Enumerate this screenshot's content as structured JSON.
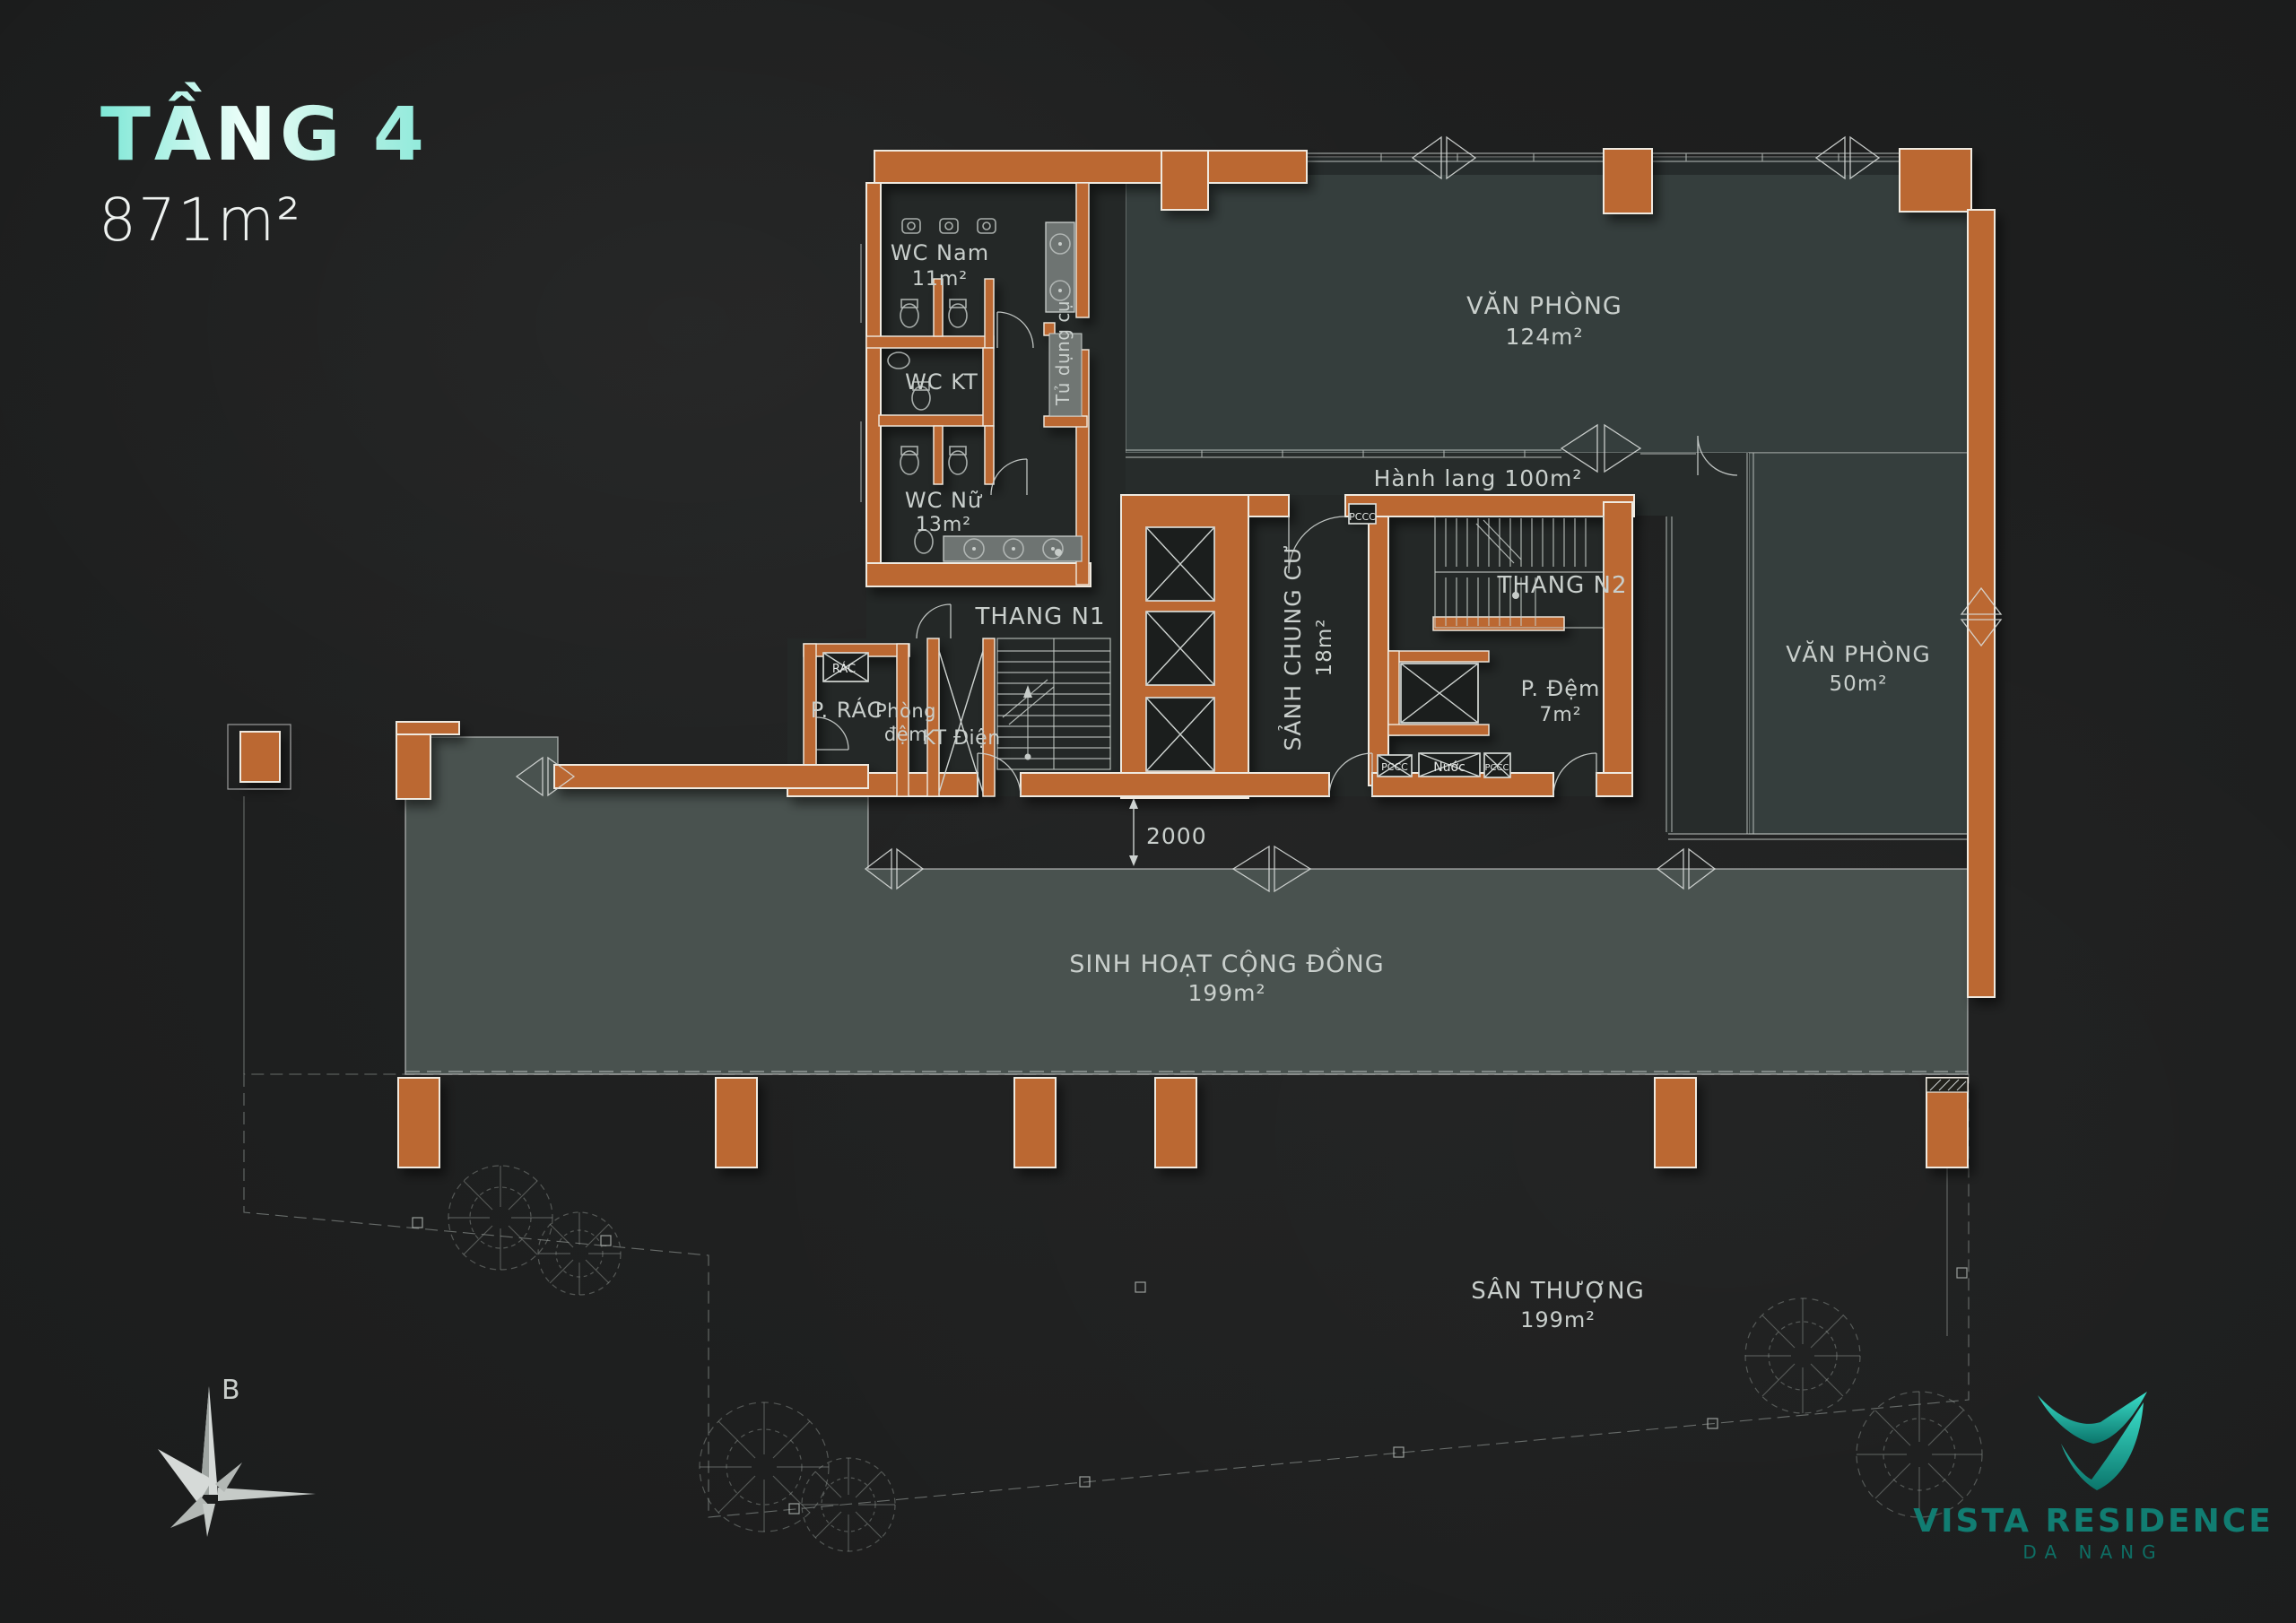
{
  "header": {
    "floor_title": "TẦNG 4",
    "floor_area": "871m²"
  },
  "colors": {
    "background": "#1b1c1c",
    "wall_orange": "#bb6830",
    "wall_outline": "#efe9df",
    "office_fill": "#353e3d",
    "community_fill": "#49524f",
    "core_fill": "#242827",
    "title_mint": "#7ee7d6",
    "logo_teal": "#117d72",
    "label_gray": "#c9cfcc"
  },
  "rooms": {
    "wc_nam": {
      "name": "WC Nam",
      "area": "11m²"
    },
    "wc_kt": {
      "name": "WC KT"
    },
    "wc_nu": {
      "name": "WC Nữ",
      "area": "13m²"
    },
    "tu_dung_cu": {
      "name": "Tủ dụng cụ"
    },
    "van_phong_124": {
      "name": "VĂN PHÒNG",
      "area": "124m²"
    },
    "hanh_lang": {
      "name": "Hành lang 100m²"
    },
    "thang_n1": {
      "name": "THANG N1"
    },
    "sanh_chung_cu": {
      "name": "SẢNH CHUNG CƯ",
      "area": "18m²"
    },
    "thang_n2": {
      "name": "THANG N2"
    },
    "p_dem": {
      "name": "P. Đệm",
      "area": "7m²"
    },
    "van_phong_50": {
      "name": "VĂN PHÒNG",
      "area": "50m²"
    },
    "p_rac": {
      "name": "P. RÁC"
    },
    "rac_chute": {
      "name": "RÁC"
    },
    "phong_dem": {
      "line1": "Phòng",
      "line2": "đệm"
    },
    "kt_dien": {
      "name": "KT Điện"
    },
    "sinh_hoat": {
      "name": "SINH HOẠT CỘNG ĐỒNG",
      "area": "199m²"
    },
    "san_thuong": {
      "name": "SÂN THƯỢNG",
      "area": "199m²"
    },
    "pccc_top": "PCCC",
    "pccc_left": "PCCC",
    "nuoc": "Nước",
    "pccc_right": "PCCC"
  },
  "dimension": {
    "value": "2000"
  },
  "compass": {
    "north": "B"
  },
  "logo": {
    "brand": "VISTA RESIDENCE",
    "location": "DA NANG"
  }
}
